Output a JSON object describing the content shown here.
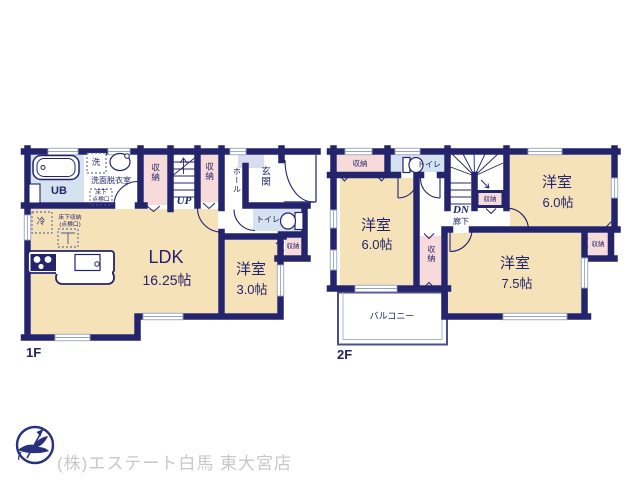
{
  "colors": {
    "wall": "#23246b",
    "room_cream": "#f6e2b9",
    "storage_pink": "#f7dbdb",
    "wet_blue": "#d5e3f1",
    "entry_lavender": "#d9dbf0",
    "footer_text": "#c8c8c8",
    "logo_navy": "#28317e"
  },
  "floor1": {
    "label": "1F",
    "rooms": {
      "ldk": {
        "name": "LDK",
        "area": "16.25帖"
      },
      "western": {
        "name": "洋室",
        "area": "3.0帖"
      },
      "bath": "UB",
      "washroom": "洗面脱衣室",
      "washer": "洗",
      "underfloor_hatch_line1": "床下",
      "underfloor_hatch_line2": "点検口",
      "storage_left": "収納",
      "storage_right": "収納",
      "stairs": "UP",
      "hall": "ホール",
      "entrance": "玄関",
      "toilet": "トイレ",
      "storage_bedroom": "収納",
      "fridge": "冷",
      "underfloor_storage_line1": "床下収納",
      "underfloor_storage_line2": "(点検口)"
    }
  },
  "floor2": {
    "label": "2F",
    "rooms": {
      "storage_tl": "収納",
      "toilet": "トイレ",
      "stairs": "DN",
      "corridor": "廊下",
      "storage_stairs": "収納",
      "western_ne": {
        "name": "洋室",
        "area": "6.0帖"
      },
      "western_w": {
        "name": "洋室",
        "area": "6.0帖"
      },
      "storage_mid": "収納",
      "western_se": {
        "name": "洋室",
        "area": "7.5帖"
      },
      "storage_e": "収納",
      "balcony": "バルコニー"
    }
  },
  "footer": {
    "company": "(株)エステート白馬 東大宮店"
  }
}
